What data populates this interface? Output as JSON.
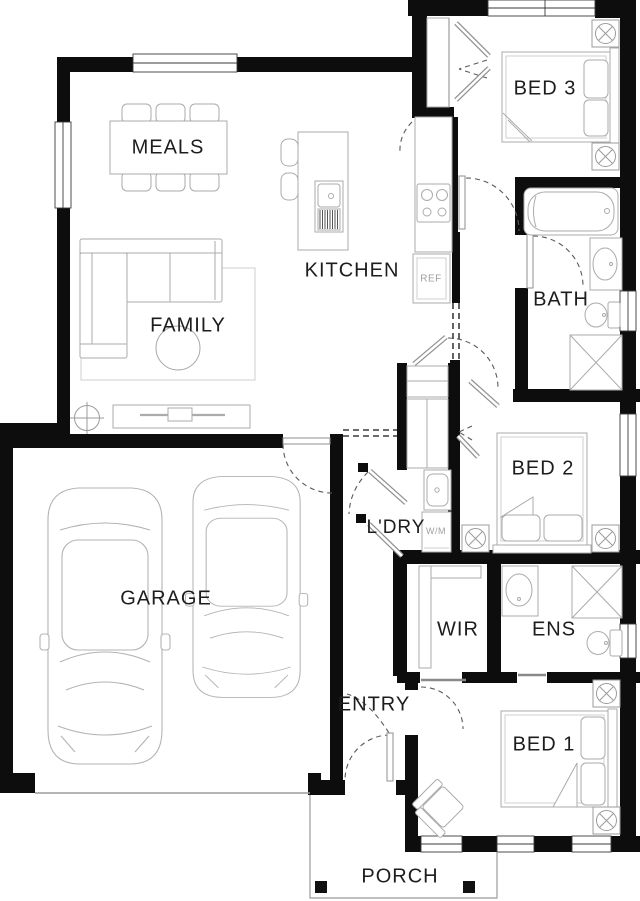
{
  "colors": {
    "background": "#ffffff",
    "wall": "#0d0d0d",
    "furniture_line": "#a9a9a9",
    "dashed_line": "#5a5a5a",
    "label_text": "#1d1d1d",
    "muted_text": "#9e9e9e"
  },
  "rooms": {
    "meals": {
      "label": "MEALS"
    },
    "kitchen": {
      "label": "KITCHEN"
    },
    "family": {
      "label": "FAMILY"
    },
    "bed3": {
      "label": "BED 3"
    },
    "bath": {
      "label": "BATH"
    },
    "bed2": {
      "label": "BED 2"
    },
    "laundry": {
      "label": "L'DRY"
    },
    "garage": {
      "label": "GARAGE"
    },
    "wir": {
      "label": "WIR"
    },
    "ens": {
      "label": "ENS"
    },
    "entry": {
      "label": "ENTRY"
    },
    "bed1": {
      "label": "BED 1"
    },
    "porch": {
      "label": "PORCH"
    }
  },
  "appliances": {
    "fridge": {
      "label": "REF"
    },
    "washing_machine": {
      "label": "W/M"
    }
  }
}
